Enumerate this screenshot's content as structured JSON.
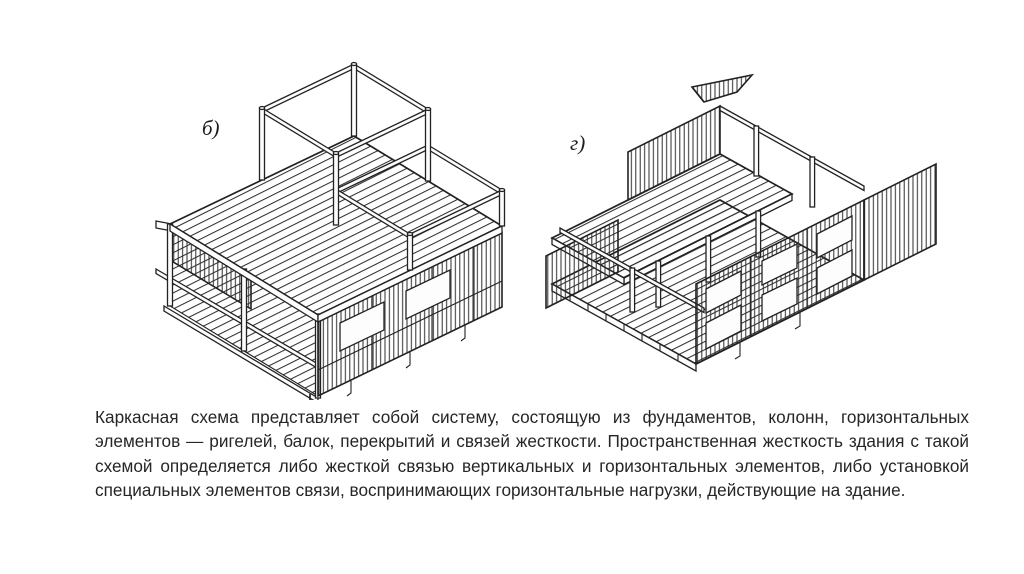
{
  "slide": {
    "background_color": "#ffffff",
    "text_color": "#262626",
    "drawing_line_color": "#222222"
  },
  "figures": {
    "left": {
      "label": "б)"
    },
    "right": {
      "label": "г)"
    }
  },
  "paragraph": {
    "text": "Каркасная схема представляет собой систему, состоящую из фундаментов, колонн, горизонтальных элементов — ригелей, балок, перекрытий и связей жесткости. Пространственная жесткость здания с такой схемой определяется либо жесткой связью вертикальных и горизонтальных элементов, либо установкой специальных элементов связи, воспринимающих горизонтальные нагрузки, действующие на здание."
  }
}
